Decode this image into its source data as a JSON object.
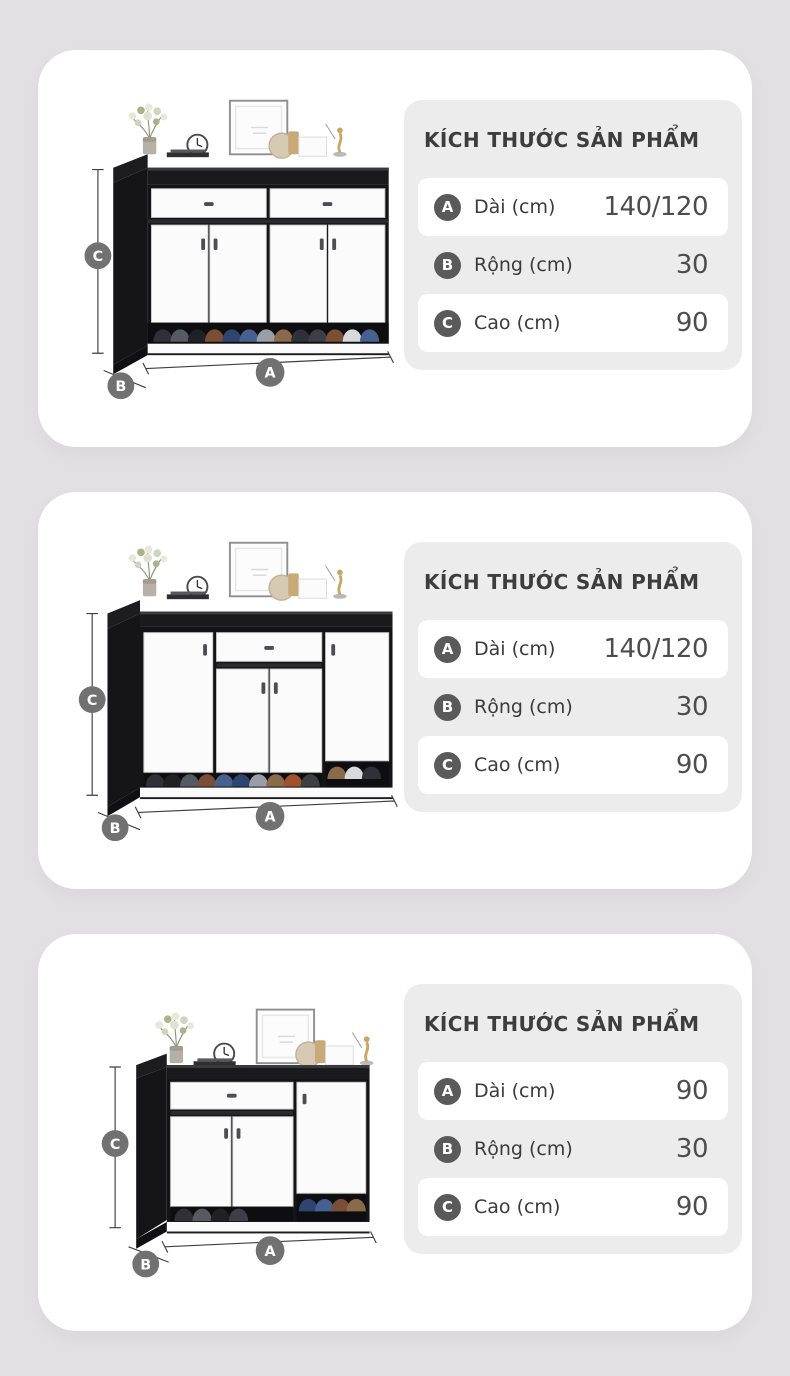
{
  "colors": {
    "page_bg": "#e2e0e2",
    "card_bg": "#ffffff",
    "info_box_bg": "#edecec",
    "row_highlight_bg": "#ffffff",
    "table_badge_bg": "#5a5a5a",
    "image_badge_bg": "#717171",
    "title_color": "#3d3d3d",
    "cabinet_frame": "#161618"
  },
  "panels": [
    {
      "title": "KÍCH THƯỚC SẢN PHẨM",
      "image_labels": {
        "a": "A",
        "b": "B",
        "c": "C"
      },
      "rows": [
        {
          "badge": "A",
          "label": "Dài (cm)",
          "value": "140/120"
        },
        {
          "badge": "B",
          "label": "Rộng (cm)",
          "value": "30"
        },
        {
          "badge": "C",
          "label": "Cao (cm)",
          "value": "90"
        }
      ]
    },
    {
      "title": "KÍCH THƯỚC SẢN PHẨM",
      "image_labels": {
        "a": "A",
        "b": "B",
        "c": "C"
      },
      "rows": [
        {
          "badge": "A",
          "label": "Dài (cm)",
          "value": "140/120"
        },
        {
          "badge": "B",
          "label": "Rộng (cm)",
          "value": "30"
        },
        {
          "badge": "C",
          "label": "Cao (cm)",
          "value": "90"
        }
      ]
    },
    {
      "title": "KÍCH THƯỚC SẢN PHẨM",
      "image_labels": {
        "a": "A",
        "b": "B",
        "c": "C"
      },
      "rows": [
        {
          "badge": "A",
          "label": "Dài (cm)",
          "value": "90"
        },
        {
          "badge": "B",
          "label": "Rộng (cm)",
          "value": "30"
        },
        {
          "badge": "C",
          "label": "Cao (cm)",
          "value": "90"
        }
      ]
    }
  ]
}
